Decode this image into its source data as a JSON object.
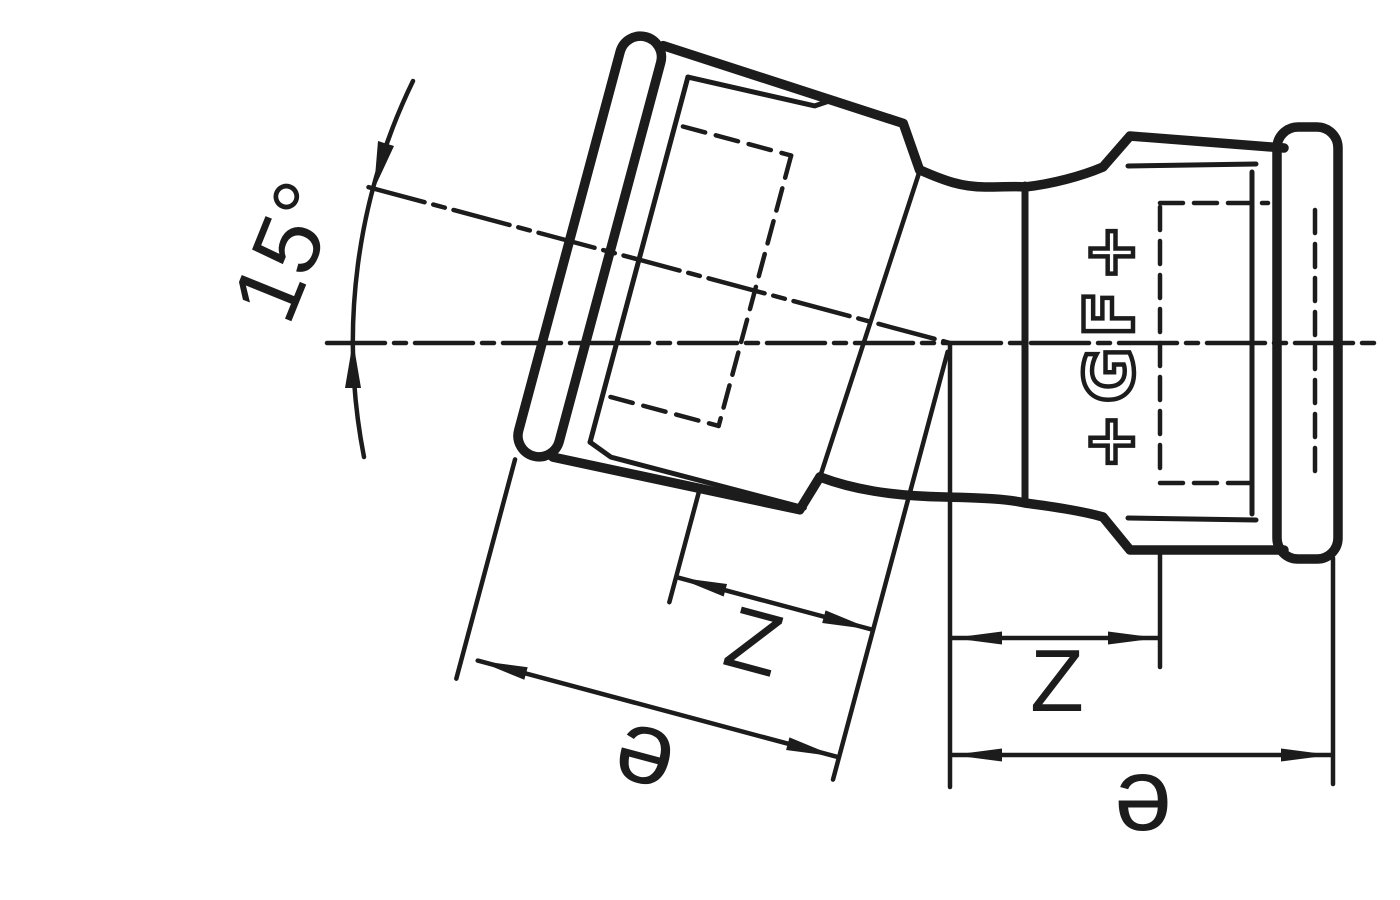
{
  "drawing": {
    "type": "technical-fitting-diagram",
    "background_color": "#ffffff",
    "line_color": "#1c1c1c",
    "annotations": {
      "angle_label": "15°",
      "left_z_label": "Z",
      "left_e_label": "e",
      "right_z_label": "Z",
      "right_e_label": "e"
    },
    "logo_text": "+GF+"
  }
}
